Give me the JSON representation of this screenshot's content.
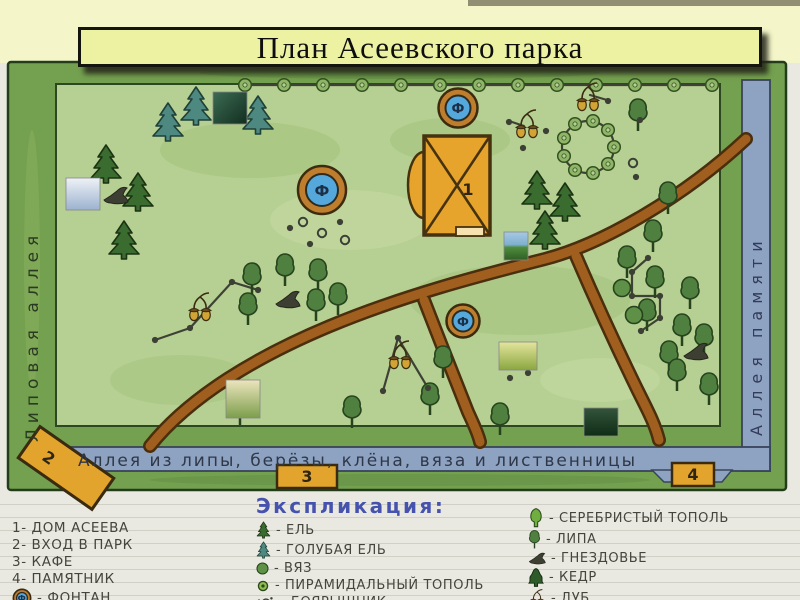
{
  "slide": {
    "title": "План Асеевского парка"
  },
  "map": {
    "alley_left": "Липовая аллея",
    "alley_right": "Аллея памяти",
    "alley_bottom": "Аллея из липы, берёзы, клёна, вяза и лиственницы",
    "fountain_letter": "Ф",
    "house_number": "1",
    "marker_entrance": "2",
    "marker_cafe": "3",
    "marker_monument": "4",
    "lines": [
      "244,85 712,85",
      "155,340 190,328 232,282 258,290",
      "383,391 398,338 428,388",
      "648,258 632,272 632,296 660,296 660,318 641,331",
      "590,95 607,100",
      "512,122 524,126"
    ],
    "features": [
      {
        "t": "bush",
        "x": 245,
        "y": 85
      },
      {
        "t": "bush",
        "x": 284,
        "y": 85
      },
      {
        "t": "bush",
        "x": 323,
        "y": 85
      },
      {
        "t": "bush",
        "x": 362,
        "y": 85
      },
      {
        "t": "bush",
        "x": 401,
        "y": 85
      },
      {
        "t": "bush",
        "x": 440,
        "y": 85
      },
      {
        "t": "bush",
        "x": 479,
        "y": 85
      },
      {
        "t": "bush",
        "x": 518,
        "y": 85
      },
      {
        "t": "bush",
        "x": 557,
        "y": 85
      },
      {
        "t": "bush",
        "x": 596,
        "y": 85
      },
      {
        "t": "bush",
        "x": 635,
        "y": 85
      },
      {
        "t": "bush",
        "x": 674,
        "y": 85
      },
      {
        "t": "bush",
        "x": 712,
        "y": 85
      },
      {
        "t": "bush",
        "x": 614,
        "y": 147
      },
      {
        "t": "bush",
        "x": 608,
        "y": 164
      },
      {
        "t": "bush",
        "x": 593,
        "y": 173
      },
      {
        "t": "bush",
        "x": 575,
        "y": 170
      },
      {
        "t": "bush",
        "x": 564,
        "y": 156
      },
      {
        "t": "bush",
        "x": 564,
        "y": 138
      },
      {
        "t": "bush",
        "x": 575,
        "y": 124
      },
      {
        "t": "bush",
        "x": 593,
        "y": 121
      },
      {
        "t": "bush",
        "x": 608,
        "y": 130
      },
      {
        "t": "spruce",
        "x": 106,
        "y": 162
      },
      {
        "t": "spruce",
        "x": 138,
        "y": 190
      },
      {
        "t": "spruce",
        "x": 124,
        "y": 238
      },
      {
        "t": "spruce",
        "x": 537,
        "y": 188
      },
      {
        "t": "spruce",
        "x": 565,
        "y": 200
      },
      {
        "t": "spruce",
        "x": 545,
        "y": 228
      },
      {
        "t": "bspruce",
        "x": 168,
        "y": 120
      },
      {
        "t": "bspruce",
        "x": 196,
        "y": 104
      },
      {
        "t": "bspruce",
        "x": 258,
        "y": 113
      },
      {
        "t": "linden",
        "x": 638,
        "y": 116
      },
      {
        "t": "linden",
        "x": 668,
        "y": 199
      },
      {
        "t": "linden",
        "x": 653,
        "y": 237
      },
      {
        "t": "linden",
        "x": 627,
        "y": 263
      },
      {
        "t": "linden",
        "x": 655,
        "y": 283
      },
      {
        "t": "linden",
        "x": 690,
        "y": 294
      },
      {
        "t": "linden",
        "x": 647,
        "y": 316
      },
      {
        "t": "linden",
        "x": 682,
        "y": 331
      },
      {
        "t": "linden",
        "x": 704,
        "y": 341
      },
      {
        "t": "linden",
        "x": 669,
        "y": 358
      },
      {
        "t": "linden",
        "x": 677,
        "y": 376
      },
      {
        "t": "linden",
        "x": 709,
        "y": 390
      },
      {
        "t": "linden",
        "x": 252,
        "y": 280
      },
      {
        "t": "linden",
        "x": 285,
        "y": 271
      },
      {
        "t": "linden",
        "x": 318,
        "y": 276
      },
      {
        "t": "linden",
        "x": 248,
        "y": 310
      },
      {
        "t": "linden",
        "x": 316,
        "y": 306
      },
      {
        "t": "linden",
        "x": 338,
        "y": 300
      },
      {
        "t": "linden",
        "x": 443,
        "y": 363
      },
      {
        "t": "linden",
        "x": 430,
        "y": 400
      },
      {
        "t": "linden",
        "x": 240,
        "y": 410
      },
      {
        "t": "linden",
        "x": 352,
        "y": 413
      },
      {
        "t": "linden",
        "x": 500,
        "y": 420
      },
      {
        "t": "elm",
        "x": 622,
        "y": 288
      },
      {
        "t": "elm",
        "x": 634,
        "y": 315
      },
      {
        "t": "acorns",
        "x": 588,
        "y": 100
      },
      {
        "t": "acorns",
        "x": 527,
        "y": 127
      },
      {
        "t": "acorns",
        "x": 200,
        "y": 310
      },
      {
        "t": "acorns",
        "x": 400,
        "y": 358
      },
      {
        "t": "nest",
        "x": 115,
        "y": 196
      },
      {
        "t": "nest",
        "x": 287,
        "y": 300
      },
      {
        "t": "nest",
        "x": 695,
        "y": 352
      },
      {
        "t": "dot",
        "x": 290,
        "y": 228
      },
      {
        "t": "dot",
        "x": 340,
        "y": 222
      },
      {
        "t": "dot",
        "x": 310,
        "y": 244
      },
      {
        "t": "dot",
        "x": 640,
        "y": 120
      },
      {
        "t": "dot",
        "x": 608,
        "y": 101
      },
      {
        "t": "dot",
        "x": 523,
        "y": 148
      },
      {
        "t": "dot",
        "x": 509,
        "y": 122
      },
      {
        "t": "dot",
        "x": 546,
        "y": 131
      },
      {
        "t": "dot",
        "x": 636,
        "y": 177
      },
      {
        "t": "dot",
        "x": 510,
        "y": 378
      },
      {
        "t": "dot",
        "x": 528,
        "y": 373
      },
      {
        "t": "dot",
        "x": 155,
        "y": 340
      },
      {
        "t": "dot",
        "x": 190,
        "y": 328
      },
      {
        "t": "dot",
        "x": 232,
        "y": 282
      },
      {
        "t": "dot",
        "x": 258,
        "y": 290
      },
      {
        "t": "dot",
        "x": 383,
        "y": 391
      },
      {
        "t": "dot",
        "x": 428,
        "y": 388
      },
      {
        "t": "dot",
        "x": 398,
        "y": 338
      },
      {
        "t": "dot",
        "x": 648,
        "y": 258
      },
      {
        "t": "dot",
        "x": 632,
        "y": 272
      },
      {
        "t": "dot",
        "x": 632,
        "y": 296
      },
      {
        "t": "dot",
        "x": 660,
        "y": 296
      },
      {
        "t": "dot",
        "x": 660,
        "y": 318
      },
      {
        "t": "dot",
        "x": 641,
        "y": 331
      },
      {
        "t": "odot",
        "x": 303,
        "y": 222
      },
      {
        "t": "odot",
        "x": 322,
        "y": 233
      },
      {
        "t": "odot",
        "x": 345,
        "y": 240
      },
      {
        "t": "odot",
        "x": 633,
        "y": 163
      },
      {
        "t": "ph1",
        "x": 230,
        "y": 108
      },
      {
        "t": "ph2",
        "x": 83,
        "y": 194
      },
      {
        "t": "ph3",
        "x": 516,
        "y": 246
      },
      {
        "t": "ph4",
        "x": 518,
        "y": 356
      },
      {
        "t": "ph5",
        "x": 601,
        "y": 422
      },
      {
        "t": "ph6",
        "x": 243,
        "y": 399
      }
    ]
  },
  "legend": {
    "title": "Экспликация:",
    "numbers": [
      "1- дом Асеева",
      "2- вход в парк",
      "3- кафе",
      "4- памятник"
    ],
    "fountain": "- фонтан",
    "plants": [
      "- ель",
      "- голубая ель",
      "- вяз",
      "- пирамидальный тополь",
      "- боярышник"
    ],
    "plants2": [
      "- серебристый тополь",
      "- липа",
      "- гнездовье",
      "- кедр",
      "- дуб"
    ]
  }
}
